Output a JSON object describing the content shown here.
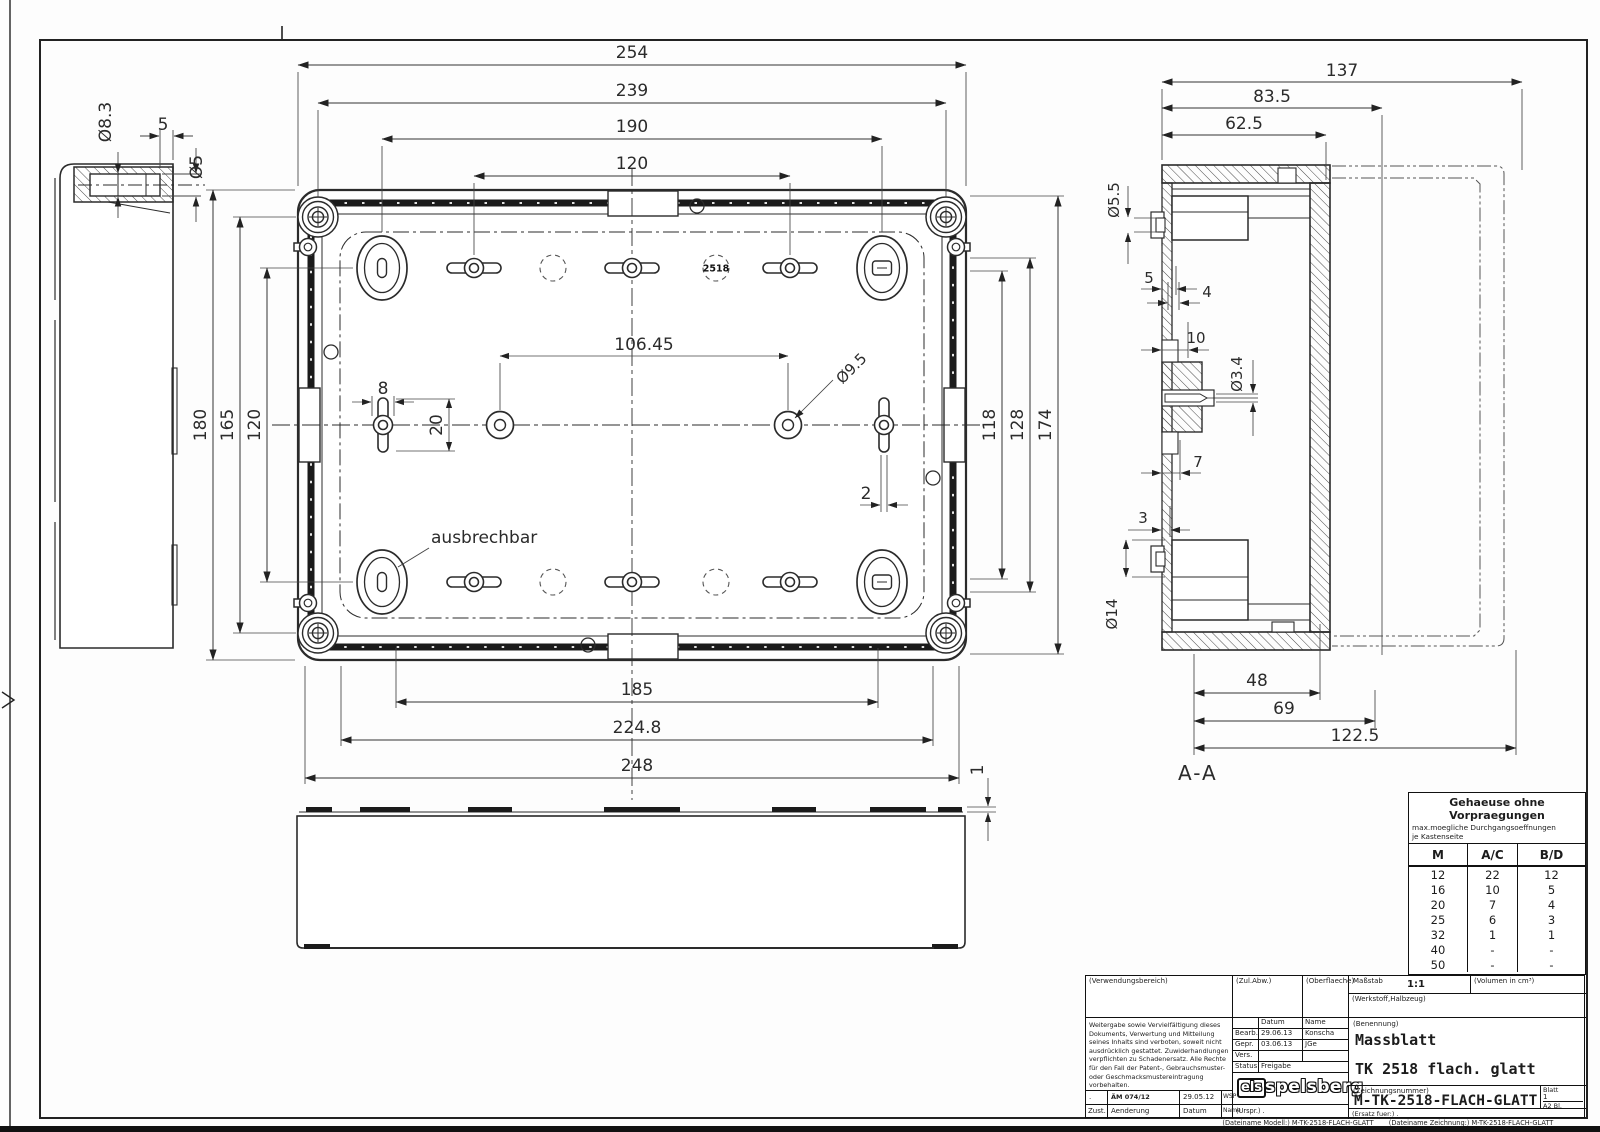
{
  "drawing": {
    "side_view": {
      "dia_bore": "Ø8.3",
      "dim_offset": "5",
      "dia_inner": "Ø5"
    },
    "top_view": {
      "dim_254": "254",
      "dim_239": "239",
      "dim_190": "190",
      "dim_120_top": "120",
      "dim_180": "180",
      "dim_165": "165",
      "dim_120_left": "120",
      "dim_118": "118",
      "dim_128": "128",
      "dim_174": "174",
      "dim_185": "185",
      "dim_224_8": "224.8",
      "dim_248": "248",
      "dim_8": "8",
      "dim_20": "20",
      "dim_106_45": "106.45",
      "dia_9_5": "Ø9.5",
      "dim_2": "2",
      "badge": "2518",
      "note_ausbrechbar": "ausbrechbar"
    },
    "section_view": {
      "label": "A-A",
      "dim_137": "137",
      "dim_83_5": "83.5",
      "dim_62_5": "62.5",
      "dia_5_5": "Ø5.5",
      "dim_5": "5",
      "dim_4": "4",
      "dim_10": "10",
      "dia_3_4": "Ø3.4",
      "dim_7": "7",
      "dim_3": "3",
      "dia_14": "Ø14",
      "dim_48": "48",
      "dim_69": "69",
      "dim_122_5": "122.5"
    },
    "bottom_view": {
      "dim_1": "1"
    }
  },
  "hole_table": {
    "title": "Gehaeuse ohne Vorpraegungen",
    "subtitle": "max.moegliche Durchgangsoeffnungen\nje Kastenseite",
    "col_m": "M",
    "col_ac": "A/C",
    "col_bd": "B/D",
    "rows": [
      [
        "12",
        "22",
        "12"
      ],
      [
        "16",
        "10",
        "5"
      ],
      [
        "20",
        "7",
        "4"
      ],
      [
        "25",
        "6",
        "3"
      ],
      [
        "32",
        "1",
        "1"
      ],
      [
        "40",
        "-",
        "-"
      ],
      [
        "50",
        "-",
        "-"
      ]
    ]
  },
  "title_block": {
    "verwendungsbereich": "(Verwendungsbereich)",
    "zul_abw": "(Zul.Abw.)",
    "oberflaeche": "(Oberflaeche)",
    "massstab_label": "Maßstab",
    "massstab_value": "1:1",
    "volumen_label": "(Volumen in cm³)",
    "werkstoff_label": "(Werkstoff,Halbzeug)",
    "legal_note": "Weitergabe sowie Vervielfältigung dieses\nDokuments, Verwertung und Mitteilung\nseines Inhalts sind verboten, soweit nicht\nausdrücklich gestattet. Zuwiderhandlungen\nverpflichten zu Schadenersatz. Alle Rechte\nfür den Fall der Patent-, Gebrauchsmuster-\noder Geschmacksmustereintragung vorbehalten.",
    "datum_header": "Datum",
    "name_header": "Name",
    "bearb_label": "Bearb.",
    "bearb_datum": "29.06.13",
    "bearb_name": "Konscha",
    "gepr_label": "Gepr.",
    "gepr_datum": "03.06.13",
    "gepr_name": "JGe",
    "vers_label": "Vers.",
    "status_label": "Status",
    "status_value": "Freigabe",
    "benennung_label": "(Benennung)",
    "benennung_line1": "Massblatt",
    "benennung_line2": "TK 2518 flach. glatt",
    "zeichnungsnummer_label": "(Zeichnungsnummer)",
    "zeichnungsnummer": "M-TK-2518-FLACH-GLATT",
    "blatt_label": "Blatt",
    "blatt_value": "1",
    "blatt_format": "A2  Bl.",
    "ersatz": "(Ersatz fuer:)  .",
    "rev_mark": ".",
    "rev_aem": "ÄM 074/12",
    "rev_datum": "29.05.12",
    "rev_name": "WSP",
    "zust_label": "Zust.",
    "aenderung_label": "Aenderung",
    "datum_label": "Datum",
    "name_label": "Name",
    "urspr": "(Urspr.) .",
    "logo_els": "els",
    "logo_name": "spelsberg"
  },
  "footer": {
    "file_model": "(Dateiname Modell:) M-TK-2518-FLACH-GLATT",
    "file_drawing": "(Dateiname Zeichnung:) M-TK-2518-FLACH-GLATT"
  }
}
